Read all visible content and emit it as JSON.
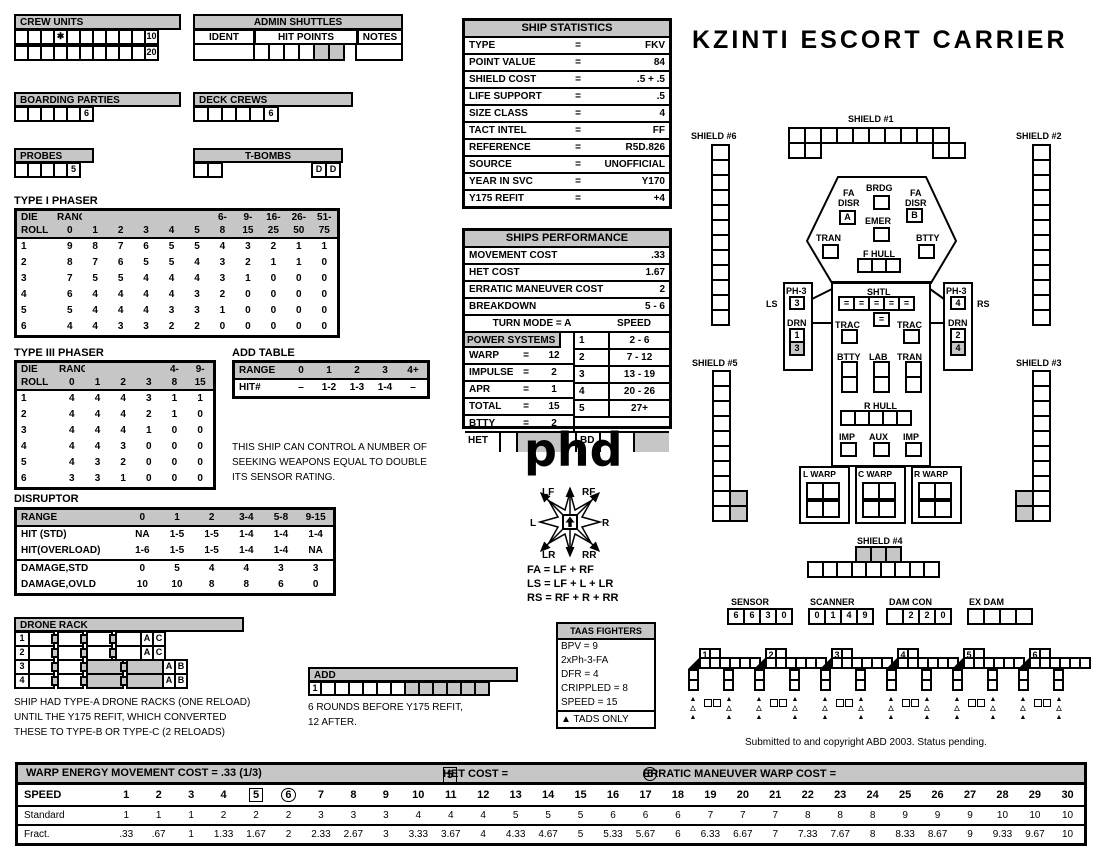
{
  "title": "KZINTI ESCORT CARRIER",
  "crew_units": {
    "title": "CREW UNITS",
    "row1": {
      "cells": [
        "",
        "",
        "",
        "✱",
        "",
        "",
        "",
        "",
        "",
        "",
        "10"
      ]
    },
    "row2": {
      "cells": [
        "",
        "",
        "",
        "",
        "",
        "",
        "",
        "",
        "",
        "",
        "20"
      ]
    }
  },
  "admin_shuttles": {
    "title": "ADMIN SHUTTLES",
    "col_ident": "IDENT",
    "col_hit": "HIT POINTS",
    "col_notes": "NOTES",
    "hit_cells": {
      "cells": [
        "",
        "",
        "",
        "",
        "",
        ""
      ],
      "gray": [
        4,
        5
      ]
    }
  },
  "boarding_parties": {
    "title": "BOARDING PARTIES",
    "row": {
      "cells": [
        "",
        "",
        "",
        "",
        "",
        "6"
      ]
    }
  },
  "deck_crews": {
    "title": "DECK CREWS",
    "row": {
      "cells": [
        "",
        "",
        "",
        "",
        "",
        "6"
      ]
    }
  },
  "probes": {
    "title": "PROBES",
    "row": {
      "cells": [
        "",
        "",
        "",
        "",
        "5"
      ]
    }
  },
  "t_bombs": {
    "title": "T-BOMBS",
    "left": {
      "cells": [
        "",
        ""
      ]
    },
    "right": {
      "cells": [
        "D",
        "D"
      ]
    }
  },
  "type1_phaser": {
    "title": "TYPE I PHASER",
    "header_top": [
      "DIE",
      "RANGE",
      "",
      "",
      "",
      "",
      "",
      "6-",
      "9-",
      "16-",
      "26-",
      "51-"
    ],
    "header_bot": [
      "ROLL",
      "0",
      "1",
      "2",
      "3",
      "4",
      "5",
      "8",
      "15",
      "25",
      "50",
      "75"
    ],
    "rows": [
      [
        "1",
        "9",
        "8",
        "7",
        "6",
        "5",
        "5",
        "4",
        "3",
        "2",
        "1",
        "1"
      ],
      [
        "2",
        "8",
        "7",
        "6",
        "5",
        "5",
        "4",
        "3",
        "2",
        "1",
        "1",
        "0"
      ],
      [
        "3",
        "7",
        "5",
        "5",
        "4",
        "4",
        "4",
        "3",
        "1",
        "0",
        "0",
        "0"
      ],
      [
        "4",
        "6",
        "4",
        "4",
        "4",
        "4",
        "3",
        "2",
        "0",
        "0",
        "0",
        "0"
      ],
      [
        "5",
        "5",
        "4",
        "4",
        "4",
        "3",
        "3",
        "1",
        "0",
        "0",
        "0",
        "0"
      ],
      [
        "6",
        "4",
        "4",
        "3",
        "3",
        "2",
        "2",
        "0",
        "0",
        "0",
        "0",
        "0"
      ]
    ]
  },
  "type3_phaser": {
    "title": "TYPE III PHASER",
    "header_top": [
      "DIE",
      "RANGE",
      "",
      "",
      "",
      "4-",
      "9-"
    ],
    "header_bot": [
      "ROLL",
      "0",
      "1",
      "2",
      "3",
      "8",
      "15"
    ],
    "rows": [
      [
        "1",
        "4",
        "4",
        "4",
        "3",
        "1",
        "1"
      ],
      [
        "2",
        "4",
        "4",
        "4",
        "2",
        "1",
        "0"
      ],
      [
        "3",
        "4",
        "4",
        "4",
        "1",
        "0",
        "0"
      ],
      [
        "4",
        "4",
        "4",
        "3",
        "0",
        "0",
        "0"
      ],
      [
        "5",
        "4",
        "3",
        "2",
        "0",
        "0",
        "0"
      ],
      [
        "6",
        "3",
        "3",
        "1",
        "0",
        "0",
        "0"
      ]
    ]
  },
  "add_table": {
    "title": "ADD TABLE",
    "header": [
      "RANGE",
      "0",
      "1",
      "2",
      "3",
      "4+"
    ],
    "rows": [
      [
        "HIT#",
        "–",
        "1-2",
        "1-3",
        "1-4",
        "–"
      ]
    ]
  },
  "seeking_note": "THIS SHIP CAN CONTROL A NUMBER OF\nSEEKING WEAPONS EQUAL TO DOUBLE\nITS SENSOR RATING.",
  "disruptor": {
    "title": "DISRUPTOR",
    "header": [
      "RANGE",
      "0",
      "1",
      "2",
      "3-4",
      "5-8",
      "9-15"
    ],
    "rows": [
      [
        "HIT (STD)",
        "NA",
        "1-5",
        "1-5",
        "1-4",
        "1-4",
        "1-4"
      ],
      [
        "HIT(OVERLOAD)",
        "1-6",
        "1-5",
        "1-5",
        "1-4",
        "1-4",
        "NA"
      ],
      [
        "DAMAGE,STD",
        "0",
        "5",
        "4",
        "4",
        "3",
        "3"
      ],
      [
        "DAMAGE,OVLD",
        "10",
        "10",
        "8",
        "8",
        "6",
        "0"
      ]
    ]
  },
  "drone_rack": {
    "title": "DRONE RACK",
    "rows": [
      {
        "num": "1",
        "letters": [
          "A",
          "C"
        ],
        "gray_groups": []
      },
      {
        "num": "2",
        "letters": [
          "A",
          "C"
        ],
        "gray_groups": []
      },
      {
        "num": "3",
        "letters": [
          "A",
          "B"
        ],
        "gray_groups": [
          2,
          3
        ]
      },
      {
        "num": "4",
        "letters": [
          "A",
          "B"
        ],
        "gray_groups": [
          2,
          3
        ]
      }
    ],
    "note": "SHIP HAD TYPE-A DRONE RACKS (ONE RELOAD)\nUNTIL THE Y175 REFIT, WHICH CONVERTED\nTHESE TO TYPE-B OR TYPE-C (2 RELOADS)"
  },
  "add_box": {
    "title": "ADD",
    "num": "1",
    "strip": {
      "count": 12,
      "gray_from": 6
    },
    "note": "6 ROUNDS BEFORE Y175 REFIT,\n12 AFTER."
  },
  "ship_statistics": {
    "title": "SHIP STATISTICS",
    "rows": [
      [
        "TYPE",
        "=",
        "FKV"
      ],
      [
        "POINT VALUE",
        "=",
        "84"
      ],
      [
        "SHIELD COST",
        "=",
        ".5 + .5"
      ],
      [
        "LIFE SUPPORT",
        "=",
        ".5"
      ],
      [
        "SIZE CLASS",
        "=",
        "4"
      ],
      [
        "TACT INTEL",
        "=",
        "FF"
      ],
      [
        "REFERENCE",
        "=",
        "R5D.826"
      ],
      [
        "SOURCE",
        "=",
        "UNOFFICIAL"
      ],
      [
        "YEAR IN SVC",
        "=",
        "Y170"
      ],
      [
        "Y175 REFIT",
        "=",
        "+4"
      ]
    ]
  },
  "ships_performance": {
    "title": "SHIPS PERFORMANCE",
    "movement_cost_label": "MOVEMENT COST",
    "movement_cost": ".33",
    "het_cost_label": "HET COST",
    "het_cost": "1.67",
    "erratic_label": "ERRATIC MANEUVER COST",
    "erratic": "2",
    "breakdown_label": "BREAKDOWN",
    "breakdown": "5 - 6",
    "turn_mode": "TURN MODE = A",
    "speed_header": "SPEED",
    "power_header": "POWER SYSTEMS",
    "power_rows": [
      [
        "WARP",
        "=",
        "12"
      ],
      [
        "IMPULSE",
        "=",
        "2"
      ],
      [
        "APR",
        "=",
        "1"
      ],
      [
        "TOTAL",
        "=",
        "15"
      ],
      [
        "BTTY",
        "=",
        "2"
      ]
    ],
    "speed_rows": [
      [
        "1",
        "2 - 6"
      ],
      [
        "2",
        "7 - 12"
      ],
      [
        "3",
        "13 - 19"
      ],
      [
        "4",
        "20 - 26"
      ],
      [
        "5",
        "27+"
      ]
    ],
    "het_label": "HET",
    "bd_label": "BD"
  },
  "phd": "phd",
  "rose": {
    "labels": {
      "lf": "LF",
      "rf": "RF",
      "l": "L",
      "r": "R",
      "lr": "LR",
      "rr": "RR"
    },
    "formulas": "FA = LF + RF\nLS = LF + L + LR\nRS = RF + R + RR"
  },
  "taas": {
    "title": "TAAS FIGHTERS",
    "lines": [
      "BPV = 9",
      "2xPh-3-FA",
      "DFR = 4",
      "CRIPPLED = 8",
      "SPEED = 15"
    ],
    "footer_icon": "▲",
    "footer": "TADS ONLY"
  },
  "shields": {
    "s1": {
      "label": "SHIELD #1",
      "top": 10,
      "bottom_left": 2,
      "bottom_right": 2
    },
    "s2": {
      "label": "SHIELD #2",
      "count": 12
    },
    "s3": {
      "label": "SHIELD #3",
      "count": 10,
      "gray_pair": 2
    },
    "s4": {
      "label": "SHIELD #4",
      "gray_top": 3,
      "bottom": 9
    },
    "s5": {
      "label": "SHIELD #5",
      "count": 10,
      "gray_pair": 2
    },
    "s6": {
      "label": "SHIELD #6",
      "count": 12
    }
  },
  "hull": {
    "brdg": "BRDG",
    "fa": "FA",
    "disr": "DISR",
    "disr_a": "A",
    "disr_b": "B",
    "emer": "EMER",
    "tran": "TRAN",
    "btty": "BTTY",
    "f_hull": "F HULL",
    "shtl": "SHTL",
    "shtl_row": {
      "cells": [
        "=",
        "=",
        "=",
        "=",
        "="
      ]
    },
    "shtl_center": {
      "cells": [
        "="
      ]
    },
    "trac": "TRAC",
    "lab": "LAB",
    "r_hull": "R HULL",
    "r_hull_count": 5,
    "f_hull_count": 3,
    "imp": "IMP",
    "aux": "AUX",
    "l_warp": "L WARP",
    "c_warp": "C WARP",
    "r_warp": "R WARP",
    "warp_cells": 4,
    "ls": "LS",
    "rs": "RS",
    "ph3": "PH-3",
    "drn": "DRN",
    "ph3_left": {
      "cells": [
        "3"
      ]
    },
    "ph3_right": {
      "cells": [
        "4"
      ]
    },
    "drn_left": {
      "cells": [
        "1",
        "3"
      ],
      "gray": [
        1
      ]
    },
    "drn_right": {
      "cells": [
        "2",
        "4"
      ],
      "gray": [
        1
      ]
    },
    "mid_cols_count": 2
  },
  "tracks": {
    "sensor": {
      "label": "SENSOR",
      "row": {
        "cells": [
          "6",
          "6",
          "3",
          "0"
        ]
      }
    },
    "scanner": {
      "label": "SCANNER",
      "row": {
        "cells": [
          "0",
          "1",
          "4",
          "9"
        ]
      }
    },
    "dam_con": {
      "label": "DAM CON",
      "row": {
        "cells": [
          "",
          "2",
          "2",
          "0"
        ]
      }
    },
    "ex_dam": {
      "label": "EX DAM",
      "row": {
        "cells": [
          "",
          "",
          "",
          ""
        ]
      }
    }
  },
  "fighters": [
    "1",
    "2",
    "3",
    "4",
    "5",
    "6"
  ],
  "copyright": "Submitted to and copyright ABD 2003. Status pending.",
  "speed_chart": {
    "header_left": "WARP ENERGY MOVEMENT COST = .33  (1/3)",
    "header_het": "HET COST = ",
    "het_value": "5",
    "header_erratic": "ERRATIC MANEUVER WARP COST =",
    "erratic_value": "6",
    "row_labels": [
      "SPEED",
      "Standard",
      "Fract."
    ],
    "boxed": "5",
    "circled": "6",
    "speeds": [
      "1",
      "2",
      "3",
      "4",
      "5",
      "6",
      "7",
      "8",
      "9",
      "10",
      "11",
      "12",
      "13",
      "14",
      "15",
      "16",
      "17",
      "18",
      "19",
      "20",
      "21",
      "22",
      "23",
      "24",
      "25",
      "26",
      "27",
      "28",
      "29",
      "30"
    ],
    "standard": [
      "1",
      "1",
      "1",
      "2",
      "2",
      "2",
      "3",
      "3",
      "3",
      "4",
      "4",
      "4",
      "5",
      "5",
      "5",
      "6",
      "6",
      "6",
      "7",
      "7",
      "7",
      "8",
      "8",
      "8",
      "9",
      "9",
      "9",
      "10",
      "10",
      "10"
    ],
    "fract": [
      ".33",
      ".67",
      "1",
      "1.33",
      "1.67",
      "2",
      "2.33",
      "2.67",
      "3",
      "3.33",
      "3.67",
      "4",
      "4.33",
      "4.67",
      "5",
      "5.33",
      "5.67",
      "6",
      "6.33",
      "6.67",
      "7",
      "7.33",
      "7.67",
      "8",
      "8.33",
      "8.67",
      "9",
      "9.33",
      "9.67",
      "10"
    ]
  }
}
